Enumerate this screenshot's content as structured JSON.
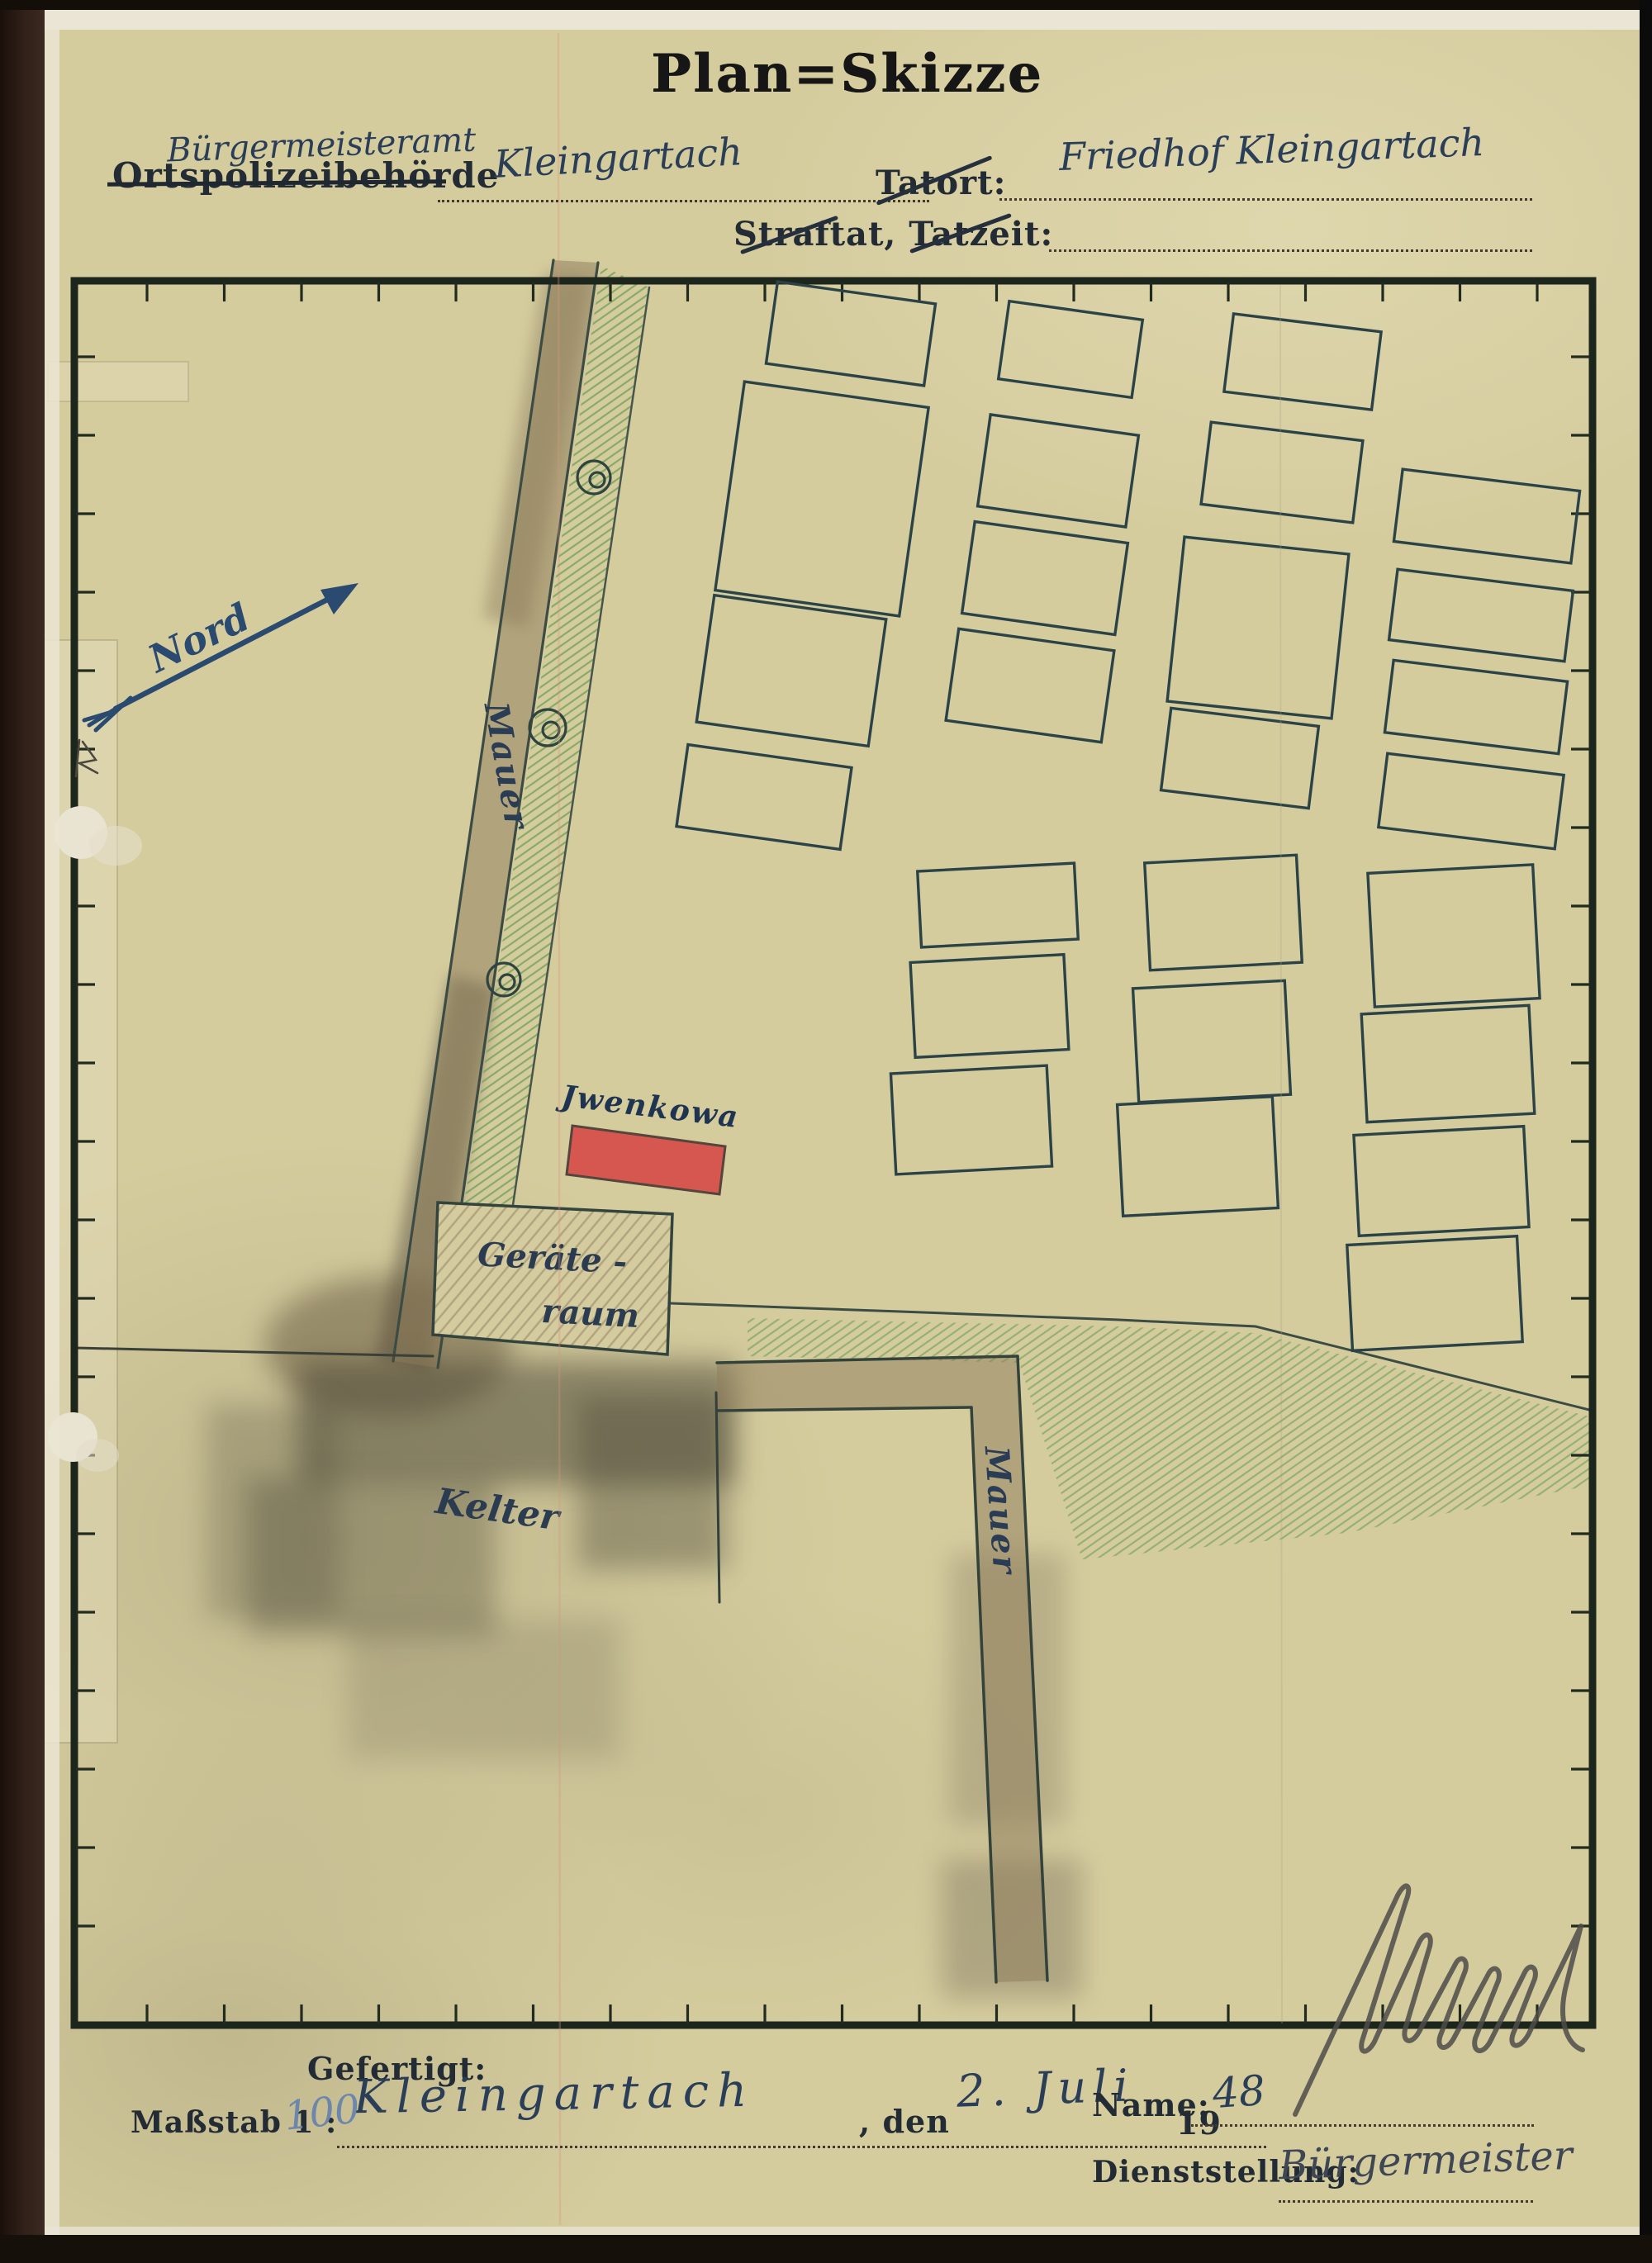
{
  "document": {
    "title": "Plan=Skizze",
    "header": {
      "office_handwritten": "Bürgermeisteramt",
      "office_printed_struckthrough": "Ortspolizeibehörde",
      "office_place": "Kleingartach",
      "tatort_label": "Tatort:",
      "tatort_value": "Friedhof Kleingartach",
      "straftat_tatzeit_label": "Straftat, Tatzeit:",
      "straftat_tatzeit_value": ""
    },
    "map": {
      "north_label": "Nord",
      "left_wall_label": "Mauer",
      "right_wall_label": "Mauer",
      "red_grave_label": "Jwenkowa",
      "shed_label_line1": "Geräte -",
      "shed_label_line2": "raum",
      "winepress_label": "Kelter",
      "graves": [
        [
          1030,
          404,
          193,
          100,
          8
        ],
        [
          995,
          604,
          225,
          255,
          8
        ],
        [
          958,
          812,
          210,
          155,
          8
        ],
        [
          925,
          965,
          200,
          100,
          8
        ],
        [
          1296,
          423,
          163,
          95,
          8
        ],
        [
          1281,
          570,
          181,
          112,
          8
        ],
        [
          1265,
          700,
          187,
          112,
          8
        ],
        [
          1247,
          830,
          190,
          112,
          8
        ],
        [
          1208,
          1096,
          190,
          92,
          -3
        ],
        [
          1198,
          1218,
          186,
          115,
          -3
        ],
        [
          1176,
          1356,
          189,
          122,
          -3
        ],
        [
          1577,
          438,
          180,
          95,
          7
        ],
        [
          1552,
          572,
          185,
          100,
          7
        ],
        [
          1523,
          760,
          200,
          200,
          6
        ],
        [
          1501,
          918,
          180,
          100,
          7
        ],
        [
          1481,
          1105,
          184,
          130,
          -3
        ],
        [
          1467,
          1261,
          184,
          138,
          -3
        ],
        [
          1450,
          1400,
          188,
          135,
          -3
        ],
        [
          1800,
          625,
          216,
          88,
          7
        ],
        [
          1793,
          745,
          214,
          86,
          7
        ],
        [
          1787,
          856,
          212,
          88,
          7
        ],
        [
          1781,
          970,
          215,
          90,
          7
        ],
        [
          1760,
          1133,
          200,
          162,
          -3
        ],
        [
          1753,
          1288,
          203,
          131,
          -3
        ],
        [
          1745,
          1430,
          206,
          122,
          -3
        ],
        [
          1737,
          1566,
          206,
          128,
          -3
        ]
      ],
      "trees": [
        [
          719,
          578,
          20
        ],
        [
          663,
          881,
          22
        ],
        [
          610,
          1186,
          20
        ]
      ]
    },
    "footer": {
      "gefertigt_label": "Gefertigt:",
      "place_value": "Kleingartach",
      "den_label": ", den",
      "date_value": "2. Juli",
      "year_prefix_printed": "19",
      "year_suffix_written": "48",
      "massstab_label": "Maßstab 1 :",
      "massstab_value": "100",
      "name_label": "Name:",
      "dienststellung_label": "Dienststellung:",
      "dienststellung_value": "Bürgermeister"
    },
    "colors": {
      "paper": "#d5cc9e",
      "ink_blue": "#2b3e58",
      "printed_black": "#232b34",
      "grave_outline": "#2b4347",
      "wall_brown": "#8d7c5a",
      "hatch_green": "#79a45c",
      "red_grave": "#d7514b",
      "pencil_gray": "#4e4c49"
    }
  }
}
